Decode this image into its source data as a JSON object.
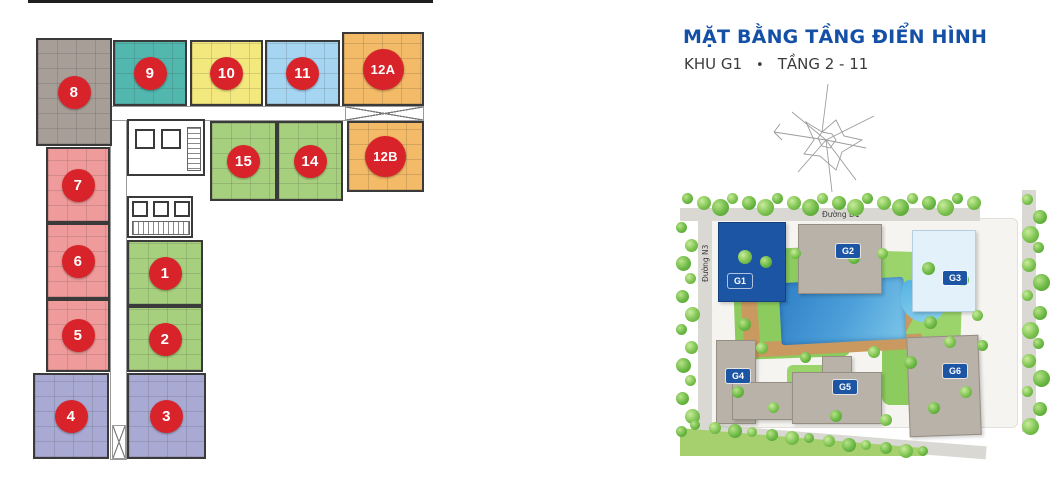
{
  "title": {
    "main": "MẶT BẰNG TẦNG ĐIỂN HÌNH",
    "khu": "KHU G1",
    "bullet": "•",
    "tang": "TẦNG 2 - 11"
  },
  "colors": {
    "title_blue": "#1450a6",
    "badge_red": "#d8232a",
    "unit_gray": "#a89e98",
    "unit_teal": "#52b7ae",
    "unit_yellow": "#f3e87d",
    "unit_blue": "#a6d5f2",
    "unit_orange": "#f3ba67",
    "unit_green": "#a7d07e",
    "unit_pink": "#f09b9b",
    "unit_purple": "#a9aad3",
    "building_highlight": "#1d55a5",
    "building_gray": "#b9b2a9",
    "building_lightblue": "#e3f1fa",
    "lawn_green": "#8ccb5e",
    "lawn_green_light": "#9ad46b",
    "path_tan": "#c9995f",
    "road_gray": "#d9d8d3",
    "pool_blue": "#3786c9"
  },
  "floor_plan": {
    "units": [
      {
        "label": "8",
        "color": "gray"
      },
      {
        "label": "9",
        "color": "teal"
      },
      {
        "label": "10",
        "color": "yellow"
      },
      {
        "label": "11",
        "color": "light-blue"
      },
      {
        "label": "12A",
        "color": "orange"
      },
      {
        "label": "15",
        "color": "green"
      },
      {
        "label": "14",
        "color": "green"
      },
      {
        "label": "12B",
        "color": "orange"
      },
      {
        "label": "7",
        "color": "pink"
      },
      {
        "label": "6",
        "color": "pink"
      },
      {
        "label": "5",
        "color": "pink"
      },
      {
        "label": "1",
        "color": "green"
      },
      {
        "label": "2",
        "color": "green"
      },
      {
        "label": "4",
        "color": "purple"
      },
      {
        "label": "3",
        "color": "purple"
      }
    ]
  },
  "site_plan": {
    "buildings": [
      {
        "label": "G1",
        "highlight": true
      },
      {
        "label": "G2",
        "highlight": false
      },
      {
        "label": "G3",
        "highlight": false
      },
      {
        "label": "G4",
        "highlight": false
      },
      {
        "label": "G5",
        "highlight": false
      },
      {
        "label": "G6",
        "highlight": false
      }
    ],
    "roads": {
      "top": "Đường D1",
      "left": "Đường N3"
    }
  }
}
